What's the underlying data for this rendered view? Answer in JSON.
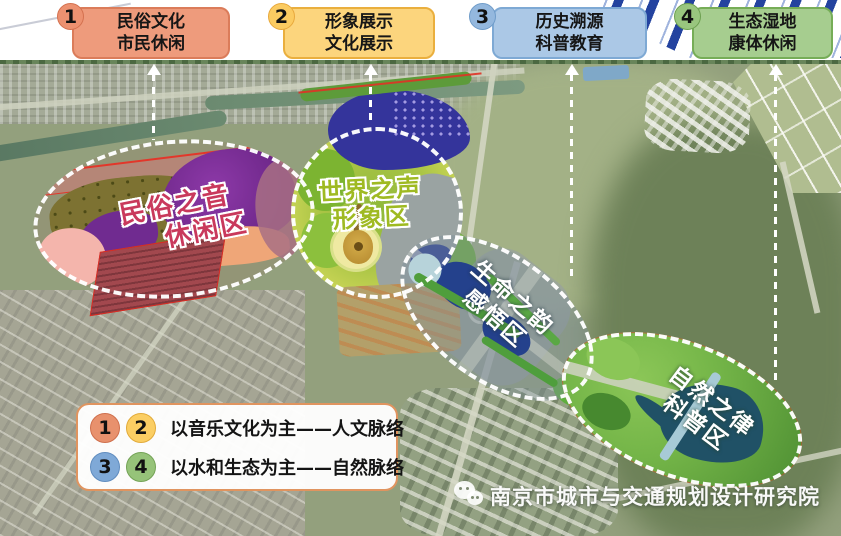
{
  "header": {
    "zones": [
      {
        "number": "1",
        "line1": "民俗文化",
        "line2": "市民休闲",
        "box_color": "#ee9b7c",
        "circle_color": "#ec9170"
      },
      {
        "number": "2",
        "line1": "形象展示",
        "line2": "文化展示",
        "box_color": "#fcd57d",
        "circle_color": "#fbcb61"
      },
      {
        "number": "3",
        "line1": "历史溯源",
        "line2": "科普教育",
        "box_color": "#abc8e6",
        "circle_color": "#94b8de"
      },
      {
        "number": "4",
        "line1": "生态湿地",
        "line2": "康体休闲",
        "box_color": "#a6cd8f",
        "circle_color": "#99c67e"
      }
    ],
    "stripe_colors": {
      "dark_blue": "#24439f",
      "light_blue": "#9fb3dd"
    }
  },
  "map": {
    "regions": [
      {
        "line1": "民俗之音",
        "line2": "休闲区",
        "label_color": "#c9395c"
      },
      {
        "line1": "世界之声",
        "line2": "形象区",
        "label_color": "#9fba22"
      },
      {
        "line1": "生命之韵",
        "line2": "感悟区",
        "label_color": "#ffffff"
      },
      {
        "line1": "自然之律",
        "line2": "科普区",
        "label_color": "#ffffff"
      }
    ],
    "feature_colors": {
      "lake_purple": "#6f2a8e",
      "lake_indigo": "#34349b",
      "lake_teal": "#205166",
      "beach_salmon": "#efa678",
      "boundary_red": "#e03226",
      "zone_outline": "#ffffff"
    }
  },
  "legend": {
    "rows": [
      {
        "numbers": [
          "1",
          "2"
        ],
        "text": "以音乐文化为主——人文脉络"
      },
      {
        "numbers": [
          "3",
          "4"
        ],
        "text": "以水和生态为主——自然脉络"
      }
    ]
  },
  "watermark": {
    "icon": "wechat-icon",
    "text": "南京市城市与交通规划设计研究院"
  }
}
